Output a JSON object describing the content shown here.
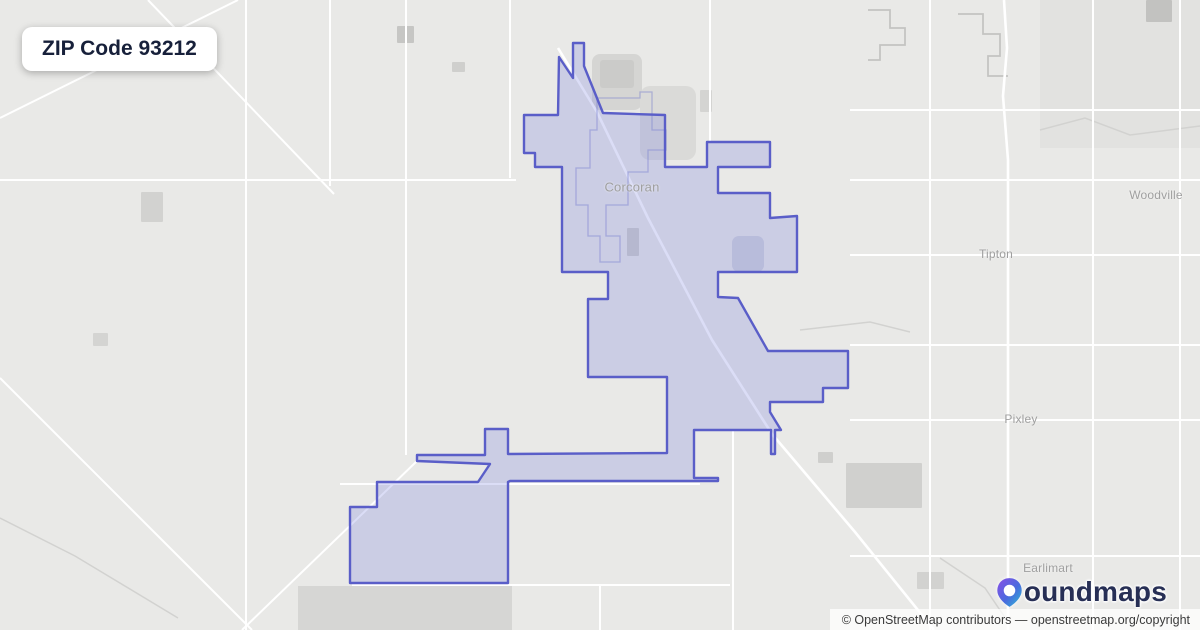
{
  "title": {
    "text": "ZIP Code 93212"
  },
  "attribution": {
    "prefix": "© OpenStreetMap contributors",
    "separator": " — ",
    "link": "openstreetmap.org/copyright"
  },
  "logo": {
    "brand": "boundmaps",
    "text_after_icon": "oundmaps",
    "icon": "map-pin-gradient",
    "color_text": "#272f55",
    "color_purple": "#8a4fe6",
    "color_teal": "#2bbcd4"
  },
  "map": {
    "background": "#e9e9e7",
    "road_color": "#ffffff",
    "stream_color": "#d2d2d0",
    "outline_color": "#c4c4c2",
    "label_color": "#9f9f9f",
    "boundary": {
      "stroke": "#5a5ec8",
      "stroke_width": 2.4,
      "fill": "#7c86dd",
      "fill_opacity": 0.28,
      "points": [
        [
          524,
          115
        ],
        [
          524,
          153
        ],
        [
          535,
          153
        ],
        [
          535,
          167
        ],
        [
          562,
          167
        ],
        [
          562,
          272
        ],
        [
          608,
          272
        ],
        [
          608,
          299
        ],
        [
          588,
          299
        ],
        [
          588,
          377
        ],
        [
          667,
          377
        ],
        [
          667,
          453
        ],
        [
          508,
          454
        ],
        [
          508,
          429
        ],
        [
          485,
          429
        ],
        [
          485,
          455
        ],
        [
          417,
          455
        ],
        [
          417,
          461
        ],
        [
          490,
          464
        ],
        [
          478,
          482
        ],
        [
          377,
          482
        ],
        [
          377,
          507
        ],
        [
          350,
          507
        ],
        [
          350,
          583
        ],
        [
          508,
          583
        ],
        [
          508,
          482
        ],
        [
          510,
          481
        ],
        [
          692,
          481
        ],
        [
          718,
          481
        ],
        [
          718,
          478
        ],
        [
          694,
          478
        ],
        [
          694,
          430
        ],
        [
          771,
          430
        ],
        [
          771,
          454
        ],
        [
          775,
          454
        ],
        [
          775,
          430
        ],
        [
          781,
          430
        ],
        [
          770,
          412
        ],
        [
          770,
          402
        ],
        [
          823,
          402
        ],
        [
          823,
          388
        ],
        [
          848,
          388
        ],
        [
          848,
          351
        ],
        [
          768,
          351
        ],
        [
          738,
          298
        ],
        [
          718,
          297
        ],
        [
          718,
          272
        ],
        [
          797,
          272
        ],
        [
          797,
          216
        ],
        [
          770,
          218
        ],
        [
          770,
          193
        ],
        [
          718,
          193
        ],
        [
          718,
          167
        ],
        [
          770,
          167
        ],
        [
          770,
          142
        ],
        [
          707,
          142
        ],
        [
          707,
          167
        ],
        [
          665,
          167
        ],
        [
          665,
          115
        ],
        [
          603,
          113
        ],
        [
          584,
          66
        ],
        [
          584,
          43
        ],
        [
          573,
          43
        ],
        [
          573,
          78
        ],
        [
          559,
          57
        ],
        [
          558,
          115
        ]
      ]
    },
    "inner_boundary": {
      "stroke": "rgba(125,132,205,0.5)",
      "points": [
        [
          597,
          98
        ],
        [
          640,
          98
        ],
        [
          640,
          92
        ],
        [
          652,
          92
        ],
        [
          652,
          130
        ],
        [
          666,
          130
        ],
        [
          666,
          150
        ],
        [
          648,
          150
        ],
        [
          648,
          172
        ],
        [
          628,
          172
        ],
        [
          628,
          205
        ],
        [
          606,
          205
        ],
        [
          606,
          236
        ],
        [
          620,
          236
        ],
        [
          620,
          262
        ],
        [
          600,
          262
        ],
        [
          600,
          236
        ],
        [
          588,
          236
        ],
        [
          588,
          205
        ],
        [
          576,
          205
        ],
        [
          576,
          168
        ],
        [
          590,
          168
        ],
        [
          590,
          130
        ],
        [
          597,
          130
        ],
        [
          597,
          98
        ]
      ]
    },
    "patches": [
      {
        "x": 1040,
        "y": 0,
        "w": 160,
        "h": 148,
        "c": "#e2e2e0",
        "r": 0
      },
      {
        "x": 397,
        "y": 26,
        "w": 17,
        "h": 17,
        "c": "#c6c6c4",
        "r": 1
      },
      {
        "x": 452,
        "y": 62,
        "w": 13,
        "h": 10,
        "c": "#cfcfcd",
        "r": 1
      },
      {
        "x": 141,
        "y": 192,
        "w": 22,
        "h": 30,
        "c": "#d2d2d0",
        "r": 1
      },
      {
        "x": 93,
        "y": 333,
        "w": 15,
        "h": 13,
        "c": "#d4d4d2",
        "r": 1
      },
      {
        "x": 1146,
        "y": 0,
        "w": 26,
        "h": 22,
        "c": "#c2c2c0",
        "r": 1
      },
      {
        "x": 592,
        "y": 54,
        "w": 50,
        "h": 56,
        "c": "#d5d5d3",
        "r": 8
      },
      {
        "x": 640,
        "y": 86,
        "w": 56,
        "h": 74,
        "c": "#dadad8",
        "r": 10
      },
      {
        "x": 600,
        "y": 60,
        "w": 34,
        "h": 28,
        "c": "#cbcbc9",
        "r": 3
      },
      {
        "x": 700,
        "y": 90,
        "w": 12,
        "h": 22,
        "c": "#d4d4d2",
        "r": 1
      },
      {
        "x": 627,
        "y": 228,
        "w": 12,
        "h": 28,
        "c": "#ccccca",
        "r": 1
      },
      {
        "x": 732,
        "y": 236,
        "w": 32,
        "h": 36,
        "c": "#cfd1da",
        "r": 7
      },
      {
        "x": 818,
        "y": 452,
        "w": 15,
        "h": 11,
        "c": "#cfcfcd",
        "r": 1
      },
      {
        "x": 846,
        "y": 463,
        "w": 76,
        "h": 45,
        "c": "#d0d0ce",
        "r": 1
      },
      {
        "x": 917,
        "y": 572,
        "w": 27,
        "h": 17,
        "c": "#d2d2d0",
        "r": 1
      },
      {
        "x": 298,
        "y": 586,
        "w": 214,
        "h": 44,
        "c": "#d6d6d4",
        "r": 0
      }
    ],
    "grid_roads": [
      [
        246,
        0,
        246,
        630
      ],
      [
        330,
        0,
        330,
        186
      ],
      [
        406,
        0,
        406,
        455
      ],
      [
        510,
        0,
        510,
        178
      ],
      [
        710,
        0,
        710,
        141
      ],
      [
        930,
        0,
        930,
        630
      ],
      [
        1093,
        0,
        1093,
        630
      ],
      [
        1180,
        0,
        1180,
        630
      ],
      [
        733,
        430,
        733,
        630
      ],
      [
        600,
        585,
        600,
        630
      ],
      [
        850,
        110,
        1200,
        110
      ],
      [
        0,
        180,
        516,
        180
      ],
      [
        850,
        180,
        1200,
        180
      ],
      [
        850,
        255,
        1200,
        255
      ],
      [
        850,
        345,
        1200,
        345
      ],
      [
        850,
        420,
        1200,
        420
      ],
      [
        340,
        484,
        700,
        484
      ],
      [
        850,
        556,
        1200,
        556
      ],
      [
        352,
        585,
        730,
        585
      ]
    ],
    "diag_roads": [
      [
        0,
        118,
        238,
        0
      ],
      [
        148,
        0,
        334,
        194
      ],
      [
        0,
        378,
        252,
        630
      ],
      [
        417,
        461,
        242,
        630
      ]
    ],
    "major_roads": [
      {
        "pts": [
          [
            558,
            48
          ],
          [
            597,
            112
          ],
          [
            648,
            218
          ],
          [
            712,
            340
          ],
          [
            772,
            434
          ],
          [
            855,
            532
          ],
          [
            934,
            630
          ]
        ]
      },
      {
        "pts": [
          [
            1004,
            0
          ],
          [
            1007,
            48
          ],
          [
            1003,
            96
          ],
          [
            1008,
            160
          ],
          [
            1008,
            630
          ]
        ]
      }
    ],
    "streams": [
      {
        "pts": [
          [
            1040,
            130
          ],
          [
            1085,
            118
          ],
          [
            1130,
            135
          ],
          [
            1200,
            126
          ]
        ]
      },
      {
        "pts": [
          [
            940,
            558
          ],
          [
            985,
            588
          ],
          [
            1008,
            622
          ]
        ]
      },
      {
        "pts": [
          [
            0,
            518
          ],
          [
            75,
            556
          ],
          [
            178,
            618
          ]
        ]
      },
      {
        "pts": [
          [
            800,
            330
          ],
          [
            870,
            322
          ],
          [
            910,
            332
          ]
        ]
      }
    ],
    "gray_outlines": [
      {
        "pts": [
          [
            868,
            10
          ],
          [
            890,
            10
          ],
          [
            890,
            28
          ],
          [
            905,
            28
          ],
          [
            905,
            45
          ],
          [
            880,
            45
          ],
          [
            880,
            60
          ],
          [
            868,
            60
          ]
        ]
      },
      {
        "pts": [
          [
            958,
            14
          ],
          [
            983,
            14
          ],
          [
            983,
            34
          ],
          [
            1000,
            34
          ],
          [
            1000,
            56
          ],
          [
            988,
            56
          ],
          [
            988,
            76
          ],
          [
            1008,
            76
          ]
        ]
      }
    ],
    "labels": [
      {
        "text": "Corcoran",
        "x": 632,
        "y": 187,
        "size": 13
      },
      {
        "text": "Woodville",
        "x": 1156,
        "y": 195,
        "size": 12
      },
      {
        "text": "Tipton",
        "x": 996,
        "y": 254,
        "size": 12
      },
      {
        "text": "Pixley",
        "x": 1021,
        "y": 419,
        "size": 12
      },
      {
        "text": "Earlimart",
        "x": 1048,
        "y": 568,
        "size": 12
      }
    ]
  }
}
